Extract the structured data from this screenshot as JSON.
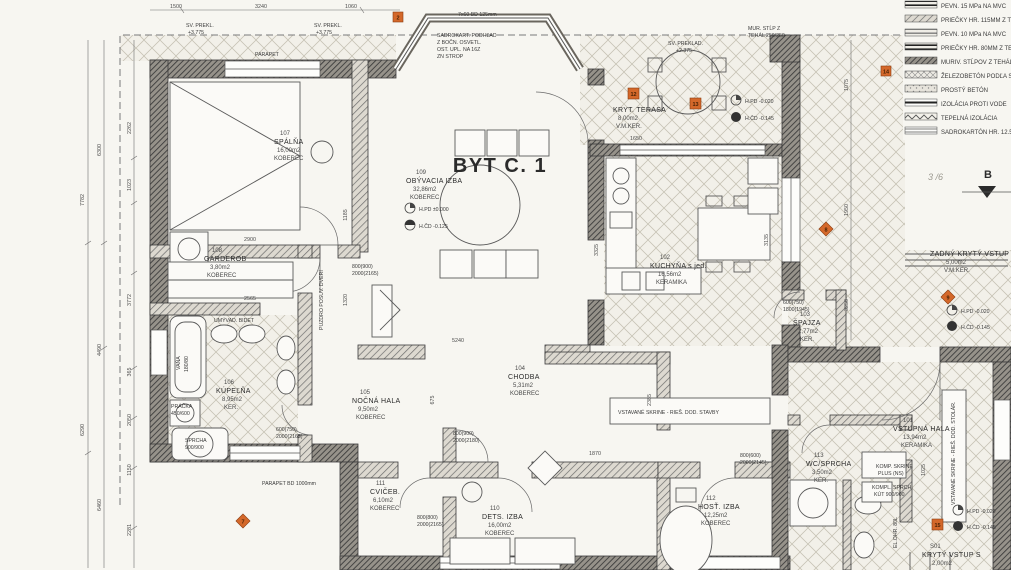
{
  "title": "BYT C. 1",
  "colors": {
    "paper": "#f7f6f1",
    "ink": "#2b2b2b",
    "marker_accent": "#d4682a"
  },
  "rooms": [
    {
      "num": "101",
      "name": "VSTUPNÁ HALA",
      "area": "13,94m2",
      "floor": "KERAMIKA"
    },
    {
      "num": "102",
      "name": "KUCHYŇA s jed.",
      "area": "16,56m2",
      "floor": "KERAMIKA"
    },
    {
      "num": "103",
      "name": "ŠPAJZA",
      "area": "2,77m2",
      "floor": "KER."
    },
    {
      "num": "104",
      "name": "CHODBA",
      "area": "5,31m2",
      "floor": "KOBEREC"
    },
    {
      "num": "105",
      "name": "NOČNÁ HALA",
      "area": "9,50m2",
      "floor": "KOBEREC"
    },
    {
      "num": "106",
      "name": "KÚPEĽŇA",
      "area": "8,95m2",
      "floor": "KER."
    },
    {
      "num": "107",
      "name": "SPÁLŇA",
      "area": "16,00m2",
      "floor": "KOBEREC"
    },
    {
      "num": "108",
      "name": "GARDEROB",
      "area": "3,80m2",
      "floor": "KOBEREC"
    },
    {
      "num": "109",
      "name": "OBÝVACIA IZBA",
      "area": "32,86m2",
      "floor": "KOBEREC"
    },
    {
      "num": "110",
      "name": "DETS. IZBA",
      "area": "16,00m2",
      "floor": "KOBEREC"
    },
    {
      "num": "111",
      "name": "CVIČEB.",
      "area": "6,10m2",
      "floor": "KOBEREC"
    },
    {
      "num": "112",
      "name": "HOSŤ. IZBA",
      "area": "12,25m2",
      "floor": "KOBEREC"
    },
    {
      "num": "113",
      "name": "WC/SPRCHA",
      "area": "3,50m2",
      "floor": "KER."
    },
    {
      "num": "",
      "name": "KRYT. TERASA",
      "area": "8,00m2",
      "floor": "V.M.KER."
    },
    {
      "num": "",
      "name": "ZADNÝ KRYTÝ VSTUP",
      "area": "5,00m2",
      "floor": "V.M.KER."
    },
    {
      "num": "S01",
      "name": "KRYTÝ VSTUP S",
      "area": "2,00m2",
      "floor": ""
    }
  ],
  "legend": [
    "PEVN. 15 MPa NA MVC",
    "PRIEČKY HR. 115MM Z TEHÁL",
    "PEVN. 10 MPa NA MVC",
    "PRIEČKY HR. 80MM Z TEHÁL",
    "MURIV. STĹPOV Z TEHÁL",
    "ŽELEZOBETÓN PODĽA STATIKY",
    "PROSTÝ BETÓN",
    "IZOLÁCIA PROTI VODE",
    "TEPELNÁ IZOLÁCIA",
    "SADROKARTÓN HR. 12.5MM"
  ],
  "markers": [
    "2",
    "12",
    "13",
    "8",
    "14",
    "9",
    "15",
    "7"
  ],
  "levels": {
    "l1a": "H.PD ±0.000",
    "l1b": "H.ČD -0.125",
    "l2a": "H.PD -0.020",
    "l2b": "H.ČD -0.145"
  },
  "notes": {
    "bay": [
      "SADROKART. PODHĽAD",
      "Z BOČN. OSVETL.",
      "OST. UPL. NA 16Z",
      "ZN STROP"
    ],
    "baytop": "7x60 BD 125mm",
    "preklad_terasa": [
      "SV. PREKLAD.",
      "+2.375"
    ],
    "preklad_tl": [
      "SV. PREKL.",
      "+3.775"
    ],
    "pillar": [
      "MUR. STĹP Z",
      "TEHÁL 250/250"
    ],
    "wardrobe_band": "VSTAVANÉ SKRINE - RIEŠ. DOD. STAVBY",
    "komp_skrine": [
      "KOMP. SKRINE",
      "PLUS (NS)"
    ],
    "vert_skrine": "VSTAVANÉ SKRINE - RIEŠ. DOD. STOLÁR.",
    "pocket_door": "PUZDRO POSUV. DVERÍ",
    "parapet": "PARAPET BD 1000mm",
    "parap_bed": "PARAPET",
    "pencil": "3 /6",
    "section": "B"
  },
  "fixtures": {
    "vana": "VAŇA",
    "vana_s": "180/80",
    "pracka": "PRÁČKA",
    "pracka_s": "450/600",
    "sprcha": "SPRCHA",
    "sprcha_s": "900/900",
    "umyv": "UMÝVAD. BIDET",
    "sprch_kut": "KOMPL. SPRCH.",
    "sprch_kut2": "KÚT 900/900",
    "boiler": "EL.OHR. 80L"
  },
  "dims": {
    "left_far": [
      "7782",
      "6290"
    ],
    "left_outer": [
      "6300",
      "4490",
      "6460"
    ],
    "left_inner": [
      "2262",
      "1023",
      "3772",
      "365",
      "2050",
      "1150",
      "2281"
    ],
    "top": [
      "1500",
      "3240",
      "1060"
    ],
    "right": [
      "1075",
      "1950",
      "3250"
    ],
    "interior": [
      "3325",
      "1650",
      "3135",
      "5240",
      "2900",
      "2565",
      "1185",
      "1320",
      "675",
      "1870",
      "2385",
      "1025"
    ],
    "doors": [
      [
        "800(900)",
        "2000(2165)"
      ],
      [
        "800(900)",
        "2000(2180)"
      ],
      [
        "800(800)",
        "2000(2165)"
      ],
      [
        "600(750)",
        "1800(1945)"
      ],
      [
        "600(750)",
        "2000(2165)"
      ],
      [
        "800(600)",
        "2000(2145)"
      ]
    ]
  }
}
